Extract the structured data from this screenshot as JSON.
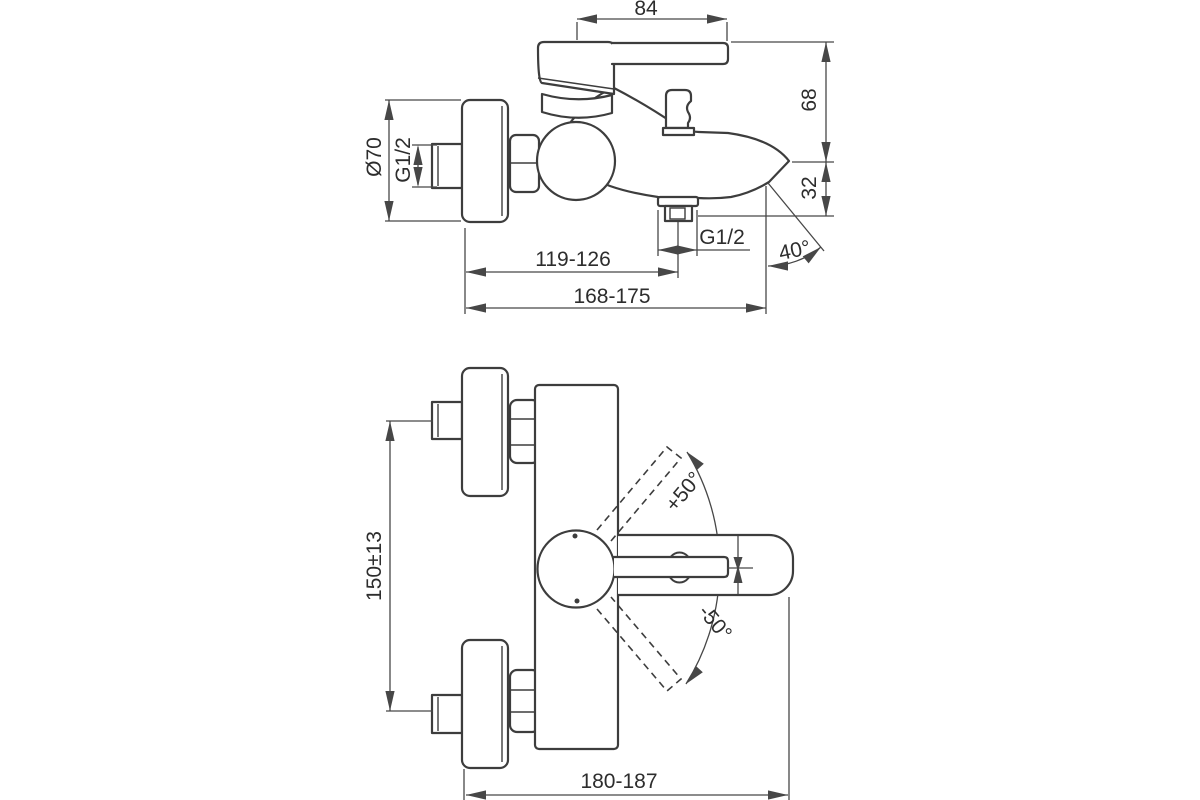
{
  "colors": {
    "background": "#ffffff",
    "object_line": "#3d3d3d",
    "dimension_line": "#474747",
    "text": "#2d2d2d"
  },
  "side_view": {
    "dim_handle_length": "84",
    "dim_height_to_spout": "68",
    "dim_spout_to_outlet": "32",
    "dim_plate_diameter": "Ø70",
    "dim_inlet_thread": "G1/2",
    "dim_outlet_thread": "G1/2",
    "dim_wall_to_outlet": "119-126",
    "dim_wall_to_tip": "168-175",
    "dim_spray_angle": "40°"
  },
  "front_view": {
    "dim_inlet_spacing": "150±13",
    "dim_lever_angle_up": "+50°",
    "dim_lever_angle_down": "-50°",
    "dim_overall_depth": "180-187"
  }
}
